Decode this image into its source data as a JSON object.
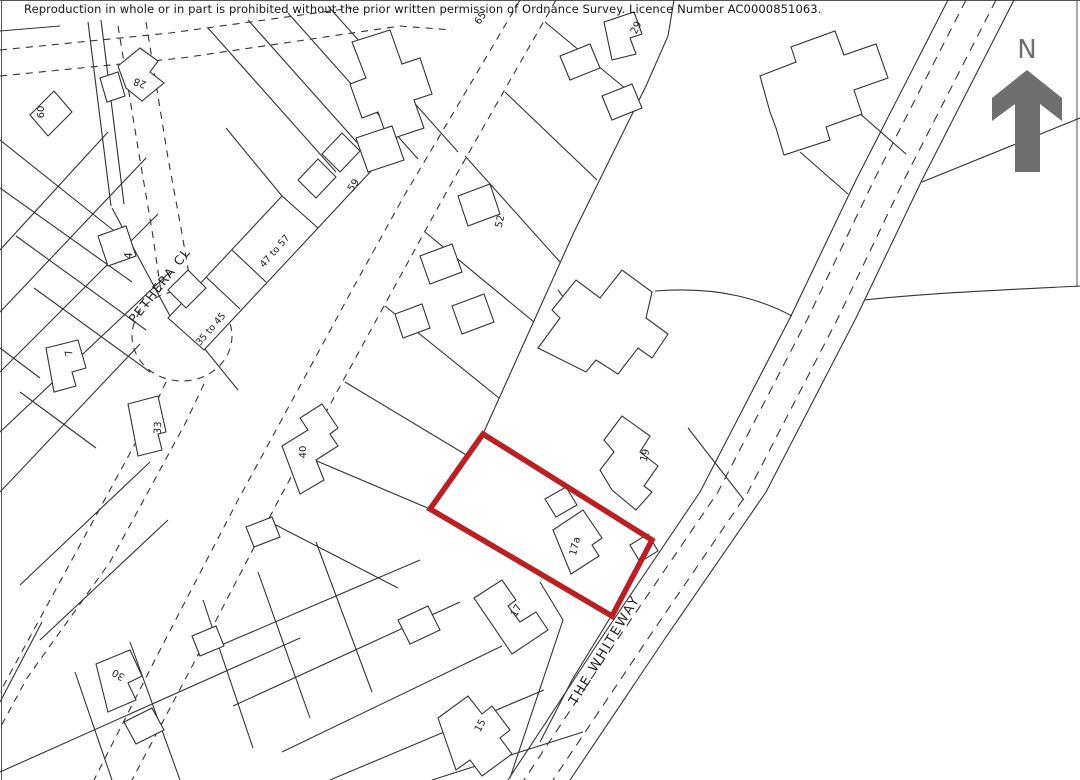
{
  "copyright": "Reproduction in whole or in part is prohibited without the prior written permission of Ordnance Survey. Licence Number AC0000851063.",
  "compass": {
    "label": "N"
  },
  "plot": {
    "highlight_number": "17a"
  },
  "colors": {
    "map_line": "#333333",
    "plot_outline": "#b91f23",
    "compass": "#6f6f6f",
    "label_text": "#1d1d1d",
    "background": "#ffffff"
  },
  "streets": [
    {
      "name": "PETHERA CL"
    },
    {
      "name": "THE WHITEWAY"
    }
  ],
  "map_labels": [
    {
      "id": "street-pethera-cl",
      "text": "PETHERA CL",
      "x": 163,
      "y": 288,
      "rot": -52,
      "size": 12.5,
      "ls": 1.5
    },
    {
      "id": "street-the-whiteway",
      "text": "THE WHITEWAY",
      "x": 608,
      "y": 652,
      "rot": -59,
      "size": 13,
      "ls": 2
    },
    {
      "id": "house-60",
      "text": "60",
      "x": 44,
      "y": 112,
      "rot": -90,
      "size": 10
    },
    {
      "id": "house-28",
      "text": "28",
      "x": 141,
      "y": 80,
      "rot": -160,
      "size": 10
    },
    {
      "id": "house-4",
      "text": "4",
      "x": 132,
      "y": 256,
      "rot": -85,
      "size": 11
    },
    {
      "id": "house-47-57",
      "text": "47 to 57",
      "x": 277,
      "y": 253,
      "rot": -49,
      "size": 9.5
    },
    {
      "id": "house-35-45",
      "text": "35 to 45",
      "x": 213,
      "y": 331,
      "rot": -49,
      "size": 9.5
    },
    {
      "id": "house-7",
      "text": "7",
      "x": 72,
      "y": 352,
      "rot": -105,
      "size": 10
    },
    {
      "id": "house-59",
      "text": "59",
      "x": 356,
      "y": 187,
      "rot": -55,
      "size": 10
    },
    {
      "id": "house-65",
      "text": "65",
      "x": 483,
      "y": 20,
      "rot": -55,
      "size": 10
    },
    {
      "id": "house-52",
      "text": "52",
      "x": 503,
      "y": 222,
      "rot": -78,
      "size": 10
    },
    {
      "id": "house-33",
      "text": "33",
      "x": 161,
      "y": 428,
      "rot": -88,
      "size": 10
    },
    {
      "id": "house-40",
      "text": "40",
      "x": 306,
      "y": 452,
      "rot": -90,
      "size": 10
    },
    {
      "id": "house-30",
      "text": "30",
      "x": 120,
      "y": 672,
      "rot": -150,
      "size": 10
    },
    {
      "id": "house-29",
      "text": "29",
      "x": 639,
      "y": 29,
      "rot": -65,
      "size": 10
    },
    {
      "id": "house-19",
      "text": "19",
      "x": 648,
      "y": 456,
      "rot": -76,
      "size": 10
    },
    {
      "id": "house-17a",
      "text": "17a",
      "x": 578,
      "y": 547,
      "rot": -76,
      "size": 10
    },
    {
      "id": "house-17",
      "text": "17",
      "x": 519,
      "y": 612,
      "rot": -62,
      "size": 10
    },
    {
      "id": "house-15",
      "text": "15",
      "x": 483,
      "y": 727,
      "rot": -62,
      "size": 10
    }
  ]
}
